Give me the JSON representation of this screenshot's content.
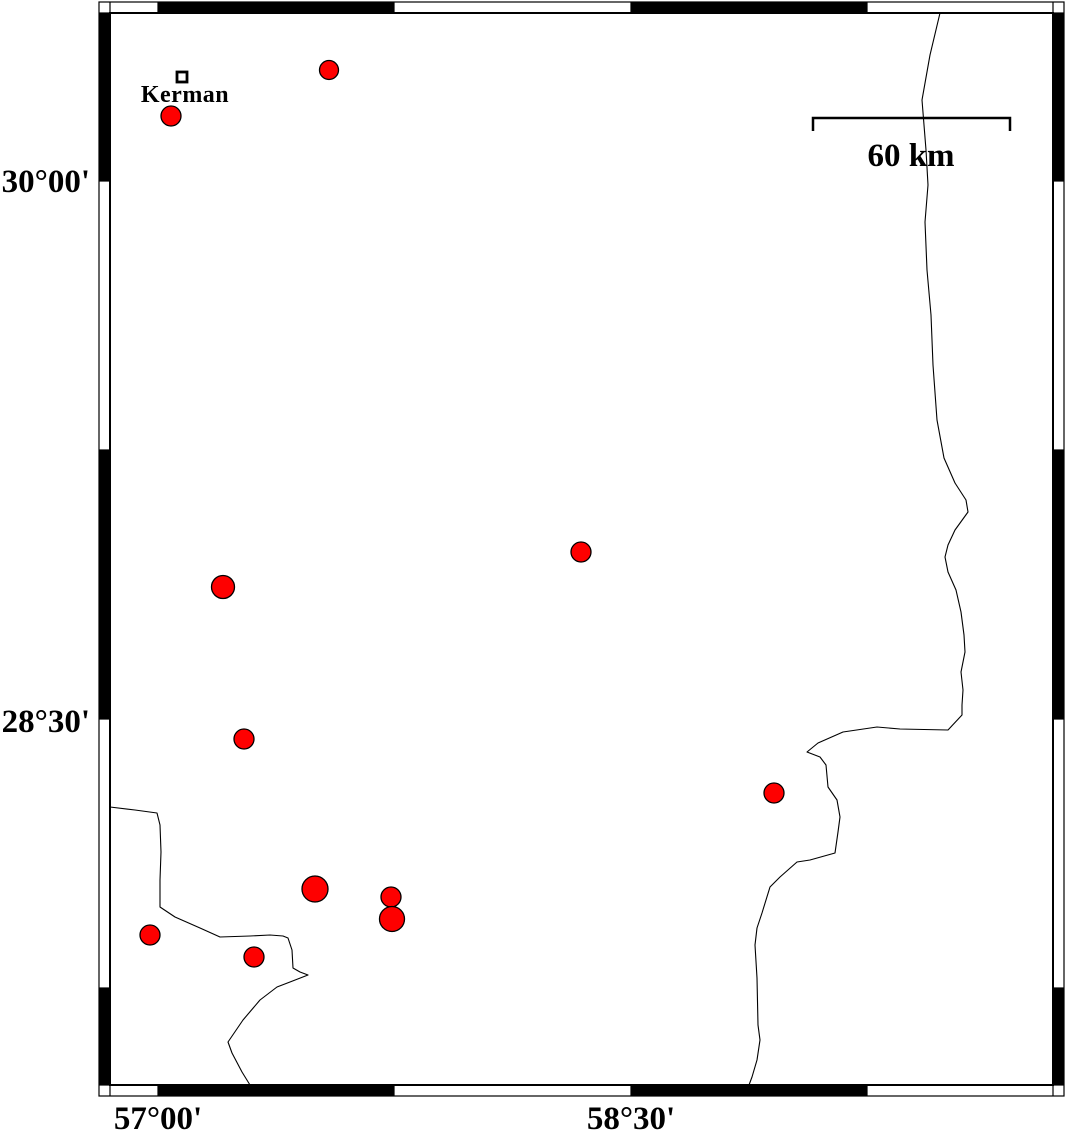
{
  "axes": {
    "left": [
      "30°00'",
      "28°30'"
    ],
    "bottom": [
      "57°00'",
      "58°30'"
    ]
  },
  "scale_bar": {
    "label": "60 km"
  },
  "city": {
    "label": "Kerman"
  },
  "colors": {
    "epicenter_fill": "#fe0000",
    "line": "#000000",
    "background": "#ffffff"
  },
  "epicenters": [
    {
      "x": 329,
      "y": 70,
      "r": 9.5
    },
    {
      "x": 171,
      "y": 116,
      "r": 10
    },
    {
      "x": 581,
      "y": 552,
      "r": 10
    },
    {
      "x": 223,
      "y": 587,
      "r": 11.5
    },
    {
      "x": 244,
      "y": 739,
      "r": 10
    },
    {
      "x": 774,
      "y": 793,
      "r": 10
    },
    {
      "x": 315,
      "y": 889,
      "r": 13
    },
    {
      "x": 391,
      "y": 897,
      "r": 10
    },
    {
      "x": 392,
      "y": 919,
      "r": 12.5
    },
    {
      "x": 150,
      "y": 935,
      "r": 10
    },
    {
      "x": 254,
      "y": 957,
      "r": 10
    }
  ],
  "boundaries": {
    "east": [
      [
        940,
        13
      ],
      [
        930,
        55
      ],
      [
        922,
        100
      ],
      [
        926,
        150
      ],
      [
        928,
        185
      ],
      [
        925,
        222
      ],
      [
        927,
        270
      ],
      [
        931,
        315
      ],
      [
        933,
        365
      ],
      [
        937,
        420
      ],
      [
        944,
        458
      ],
      [
        955,
        483
      ],
      [
        966,
        500
      ],
      [
        968,
        512
      ],
      [
        955,
        530
      ],
      [
        948,
        545
      ],
      [
        945,
        557
      ],
      [
        948,
        572
      ],
      [
        956,
        590
      ],
      [
        961,
        612
      ],
      [
        964,
        635
      ],
      [
        965,
        652
      ],
      [
        961,
        672
      ],
      [
        963,
        690
      ],
      [
        962,
        705
      ],
      [
        962,
        715
      ],
      [
        948,
        730
      ],
      [
        900,
        729
      ],
      [
        877,
        727
      ],
      [
        843,
        732
      ],
      [
        818,
        743
      ],
      [
        807,
        752
      ],
      [
        820,
        757
      ],
      [
        826,
        765
      ],
      [
        828,
        787
      ],
      [
        837,
        800
      ],
      [
        840,
        817
      ],
      [
        838,
        832
      ],
      [
        835,
        853
      ],
      [
        810,
        860
      ],
      [
        797,
        862
      ],
      [
        780,
        877
      ],
      [
        770,
        887
      ],
      [
        762,
        913
      ],
      [
        757,
        928
      ],
      [
        755,
        945
      ],
      [
        757,
        978
      ],
      [
        758,
        1025
      ],
      [
        760,
        1040
      ],
      [
        757,
        1060
      ],
      [
        752,
        1077
      ],
      [
        749,
        1085
      ]
    ],
    "southwest": [
      [
        110,
        807
      ],
      [
        135,
        810
      ],
      [
        157,
        813
      ],
      [
        160,
        825
      ],
      [
        161,
        852
      ],
      [
        160,
        880
      ],
      [
        160,
        907
      ],
      [
        175,
        917
      ],
      [
        200,
        928
      ],
      [
        220,
        937
      ],
      [
        250,
        936
      ],
      [
        270,
        935
      ],
      [
        283,
        936
      ],
      [
        288,
        938
      ],
      [
        292,
        950
      ],
      [
        293,
        968
      ],
      [
        300,
        972
      ],
      [
        308,
        975
      ],
      [
        290,
        982
      ],
      [
        277,
        987
      ],
      [
        260,
        1000
      ],
      [
        243,
        1020
      ],
      [
        228,
        1042
      ],
      [
        232,
        1053
      ],
      [
        242,
        1072
      ],
      [
        250,
        1085
      ]
    ]
  }
}
